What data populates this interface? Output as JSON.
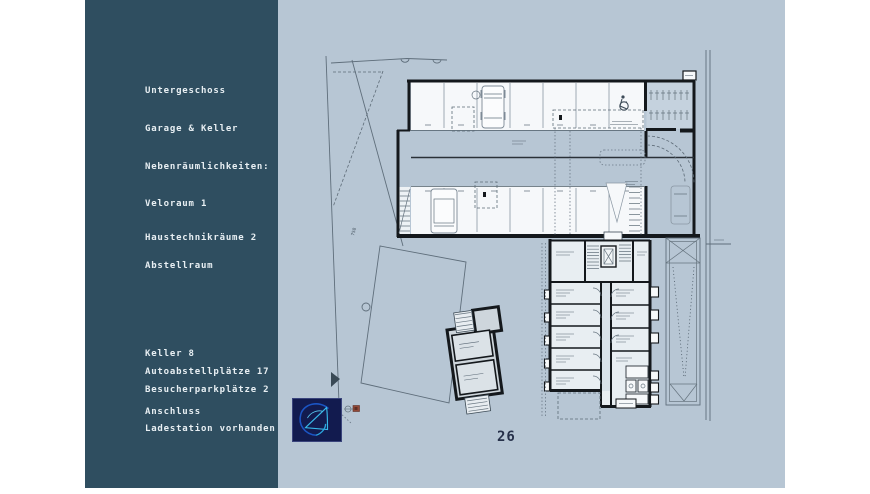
{
  "sidebar": {
    "lines": [
      "Untergeschoss",
      "Garage & Keller",
      "Nebenräumlichkeiten:",
      "Veloraum 1",
      "Haustechnikräume 2",
      "Abstellraum",
      "Keller 8",
      "Autoabstellplätze 17",
      "Besucherparkplätze 2",
      "Anschluss",
      "Ladestation vorhanden"
    ]
  },
  "plan": {
    "page_number": "26",
    "parcel_label": "758"
  },
  "colors": {
    "sidebar_bg": "#2f4e60",
    "slide_bg": "#b7c6d4",
    "logo_bg": "#121b4f",
    "logo_accent": "#38b9ea",
    "wall_ink": "#14181c"
  }
}
